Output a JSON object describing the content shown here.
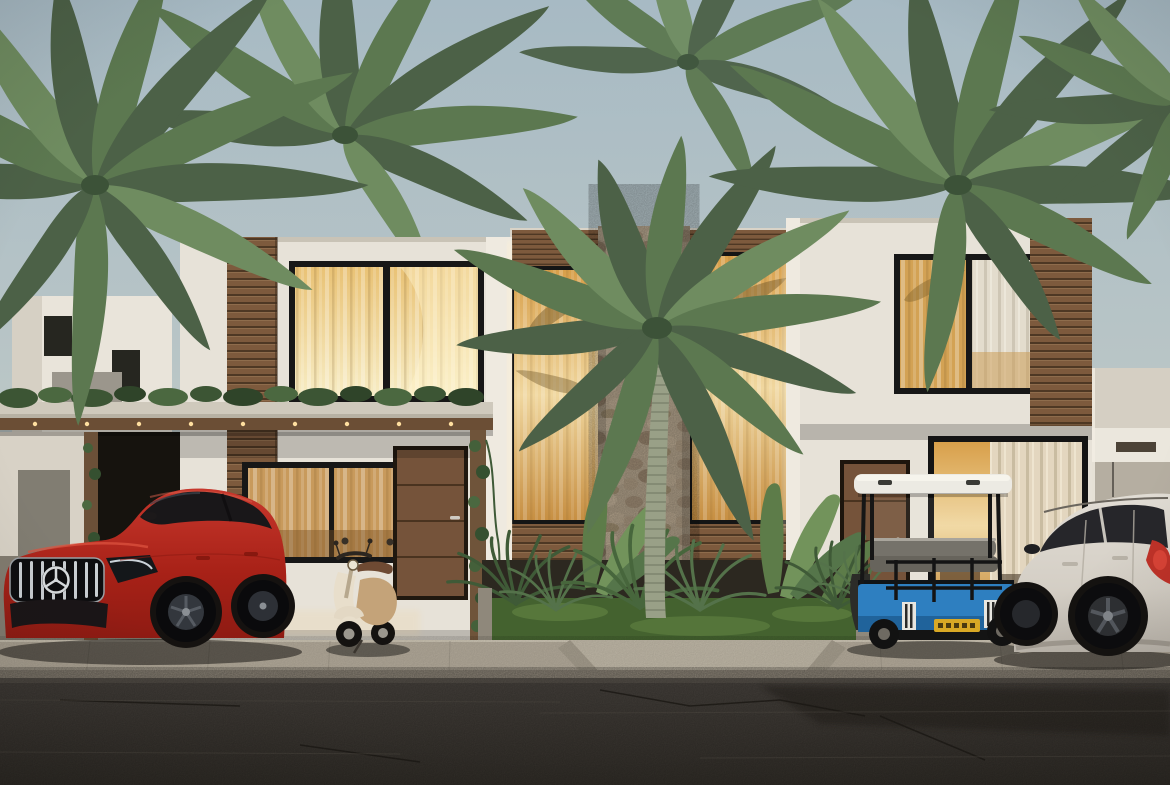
{
  "scene": {
    "subject": "Modern two-story tropical townhouses with palm trees, parked vehicles and street (architectural render)",
    "sky": {
      "top": "#a7bac4",
      "bottom": "#cdd2c9"
    },
    "palms": {
      "dark": "#4c6147",
      "mid": "#5c7850",
      "light": "#6f8c60",
      "trunk": "#99a087"
    },
    "buildings": {
      "wall": "#e7e2d8",
      "wall_recessed": "#d9d3c7",
      "pillar": "#efeae0",
      "wing_wall": "#d5cfc3",
      "wood_slat": "#7d5a3d",
      "wood_slat_dark": "#4e3824",
      "stone": "#b2a28b",
      "window_frame": "#171717",
      "glass_top": "#d89f4a",
      "glass_mid": "#f0d79f",
      "glass_bottom": "#c78f42",
      "upper_glass_left": "#e9c275",
      "upper_glass_right": "#f7ecc3",
      "curtain_white": "#e7e0d1",
      "door_wood": "#75533a",
      "pergola_slab": "#cfc9bc",
      "pergola_beam": "#6b4e35",
      "greenery": "#3c5534",
      "light_glow": "#ffdf9f"
    },
    "ground": {
      "courtyard": "#a79f91",
      "sidewalk": "#b5ac9c",
      "ramp": "#c2baa9",
      "road": "#4a4540",
      "road_bottom": "#35312b",
      "grass": "#44622f",
      "soil": "#2c2820"
    },
    "vehicles": {
      "red_suv": {
        "label": "red luxury coupe SUV with chrome slat grille and three-pointed-star emblem",
        "body": "#b5271c",
        "body_dark": "#6f110b",
        "highlight": "#de5440",
        "glass": "#191719",
        "grille_chrome": "#c9ced2"
      },
      "scooter": {
        "label": "cream retro scooter",
        "body": "#e8decb",
        "accent": "#c4a379",
        "seat": "#6e4a33"
      },
      "golf_cart": {
        "label": "blue golf cart with white roof and yellow license plate",
        "body": "#2e7fc0",
        "body_dark": "#1d5e95",
        "roof": "#eceae3",
        "frame": "#161616",
        "seat": "#75726a",
        "plate": "#d8a825"
      },
      "white_suv": {
        "label": "white crossover SUV seen from rear quarter",
        "body": "#d9d4cb",
        "glass": "#26262a",
        "taillight": "#c03228",
        "wheel": "#121214"
      }
    }
  }
}
